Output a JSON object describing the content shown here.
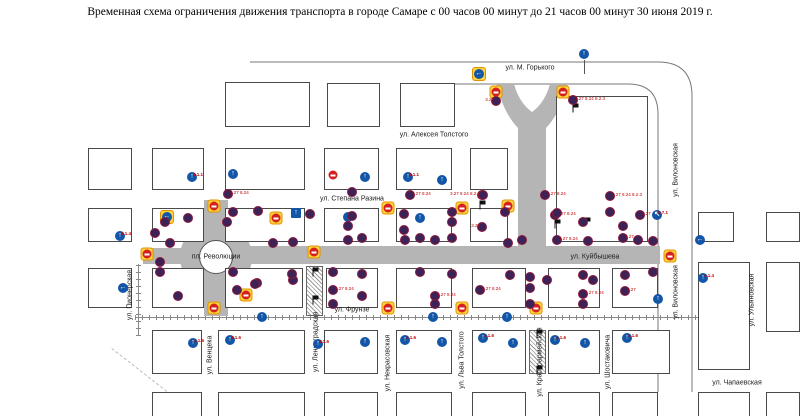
{
  "title": "Временная схема ограничения движения транспорта в городе Самаре  с 00 часов 00 минут  до 21 часов 00 минут 30 июня 2019 г.",
  "map": {
    "colors": {
      "road": "#b5b5b5",
      "no_stop_sign": "#3d2257",
      "no_entry_red": "#d42020",
      "highlight_yellow": "#ffd43a",
      "mandatory_blue": "#1356a8",
      "sign_label_red": "#c00000"
    },
    "square_label": "пл. Революции",
    "blocks": [
      [
        225,
        82,
        85,
        45
      ],
      [
        327,
        83,
        53,
        44
      ],
      [
        400,
        83,
        55,
        44
      ],
      [
        556,
        96,
        92,
        146
      ],
      [
        88,
        148,
        44,
        42
      ],
      [
        152,
        148,
        52,
        42
      ],
      [
        225,
        148,
        80,
        42
      ],
      [
        324,
        148,
        55,
        42
      ],
      [
        396,
        148,
        56,
        42
      ],
      [
        470,
        148,
        38,
        42
      ],
      [
        88,
        208,
        44,
        34
      ],
      [
        152,
        208,
        52,
        34
      ],
      [
        225,
        208,
        80,
        34
      ],
      [
        324,
        208,
        55,
        34
      ],
      [
        396,
        208,
        56,
        34
      ],
      [
        470,
        208,
        38,
        34
      ],
      [
        698,
        212,
        36,
        30
      ],
      [
        766,
        212,
        34,
        30
      ],
      [
        88,
        268,
        44,
        40
      ],
      [
        152,
        268,
        52,
        40
      ],
      [
        225,
        268,
        78,
        40
      ],
      [
        326,
        268,
        52,
        40
      ],
      [
        396,
        268,
        56,
        40
      ],
      [
        472,
        268,
        54,
        40
      ],
      [
        548,
        268,
        52,
        40
      ],
      [
        612,
        268,
        46,
        40
      ],
      [
        698,
        262,
        52,
        108
      ],
      [
        766,
        262,
        34,
        70
      ],
      [
        152,
        330,
        50,
        44
      ],
      [
        218,
        330,
        87,
        44
      ],
      [
        324,
        330,
        54,
        44
      ],
      [
        396,
        330,
        56,
        44
      ],
      [
        472,
        330,
        54,
        44
      ],
      [
        548,
        330,
        52,
        44
      ],
      [
        612,
        330,
        58,
        44
      ],
      [
        152,
        392,
        50,
        26
      ],
      [
        218,
        392,
        87,
        26
      ],
      [
        324,
        392,
        54,
        26
      ],
      [
        396,
        392,
        56,
        26
      ],
      [
        472,
        392,
        54,
        26
      ],
      [
        548,
        392,
        52,
        26
      ],
      [
        612,
        392,
        46,
        26
      ],
      [
        698,
        392,
        52,
        26
      ],
      [
        766,
        392,
        34,
        26
      ]
    ],
    "roads": [
      [
        250,
        246,
        410,
        18
      ],
      [
        143,
        248,
        40,
        16
      ],
      [
        204,
        200,
        24,
        28
      ],
      [
        204,
        290,
        24,
        26
      ]
    ],
    "hatches": [
      [
        306,
        266,
        17,
        50
      ],
      [
        529,
        330,
        17,
        44
      ]
    ],
    "street_labels_h": [
      {
        "t": "ул. М. Горького",
        "x": 530,
        "y": 68
      },
      {
        "t": "ул. Алексея Толстого",
        "x": 434,
        "y": 135
      },
      {
        "t": "ул. Степана Разина",
        "x": 352,
        "y": 199
      },
      {
        "t": "ул. Куйбышева",
        "x": 595,
        "y": 257
      },
      {
        "t": "ул. Фрунзе",
        "x": 352,
        "y": 310
      },
      {
        "t": "ул. Чапаевская",
        "x": 737,
        "y": 383
      },
      {
        "t": "пл. Революции",
        "x": 216,
        "y": 257
      }
    ],
    "street_labels_v": [
      {
        "t": "ул. Пионерская",
        "x": 130,
        "y": 295
      },
      {
        "t": "ул. Венцека",
        "x": 210,
        "y": 355
      },
      {
        "t": "ул. Ленинградская",
        "x": 316,
        "y": 342
      },
      {
        "t": "ул. Некрасовская",
        "x": 388,
        "y": 363
      },
      {
        "t": "ул. Льва Толстого",
        "x": 462,
        "y": 360
      },
      {
        "t": "ул. Красноармейская",
        "x": 540,
        "y": 362
      },
      {
        "t": "ул. Шостаковича",
        "x": 608,
        "y": 362
      },
      {
        "t": "ул. Вилоновская",
        "x": 676,
        "y": 170
      },
      {
        "t": "ул. Вилоновская",
        "x": 676,
        "y": 292
      },
      {
        "t": "ул. Ульяновская",
        "x": 752,
        "y": 300
      }
    ],
    "signs": [
      {
        "t": "ne",
        "x": 496,
        "y": 92
      },
      {
        "t": "ne",
        "x": 563,
        "y": 92
      },
      {
        "t": "ne",
        "x": 214,
        "y": 206
      },
      {
        "t": "ne",
        "x": 147,
        "y": 254
      },
      {
        "t": "ne",
        "x": 276,
        "y": 218
      },
      {
        "t": "ne",
        "x": 314,
        "y": 252
      },
      {
        "t": "ne",
        "x": 388,
        "y": 208
      },
      {
        "t": "ne",
        "x": 462,
        "y": 208
      },
      {
        "t": "ne",
        "x": 508,
        "y": 206
      },
      {
        "t": "ne",
        "x": 214,
        "y": 308
      },
      {
        "t": "ne",
        "x": 388,
        "y": 308
      },
      {
        "t": "ne",
        "x": 462,
        "y": 308
      },
      {
        "t": "ne",
        "x": 536,
        "y": 308
      },
      {
        "t": "ne",
        "x": 670,
        "y": 256
      },
      {
        "t": "ne",
        "x": 246,
        "y": 295
      },
      {
        "t": "nes",
        "x": 333,
        "y": 175
      },
      {
        "t": "by",
        "x": 479,
        "y": 74,
        "g": "←"
      },
      {
        "t": "by",
        "x": 167,
        "y": 217,
        "g": "←"
      },
      {
        "t": "ow",
        "x": 296,
        "y": 213,
        "g": "↑"
      },
      {
        "t": "pole",
        "x": 584,
        "y": 60,
        "h": 14
      },
      {
        "t": "bc",
        "x": 584,
        "y": 54,
        "g": "↑"
      },
      {
        "t": "bc",
        "x": 120,
        "y": 236,
        "g": "↑",
        "l": "4.1.4"
      },
      {
        "t": "bc",
        "x": 123,
        "y": 288,
        "g": "←"
      },
      {
        "t": "bc",
        "x": 192,
        "y": 177,
        "g": "↑",
        "l": "4.1.1"
      },
      {
        "t": "bc",
        "x": 233,
        "y": 174,
        "g": "↑"
      },
      {
        "t": "bc",
        "x": 365,
        "y": 177,
        "g": "↑"
      },
      {
        "t": "bc",
        "x": 408,
        "y": 177,
        "g": "↑",
        "l": "4.1.1"
      },
      {
        "t": "bc",
        "x": 442,
        "y": 180,
        "g": "↑"
      },
      {
        "t": "bc",
        "x": 348,
        "y": 217,
        "g": "↑"
      },
      {
        "t": "bc",
        "x": 420,
        "y": 218,
        "g": "↑"
      },
      {
        "t": "bc",
        "x": 657,
        "y": 215,
        "g": "↖",
        "l": "5.7.1"
      },
      {
        "t": "bc",
        "x": 700,
        "y": 240,
        "g": "←"
      },
      {
        "t": "bc",
        "x": 703,
        "y": 278,
        "g": "↑",
        "l": "4.1.4"
      },
      {
        "t": "bc",
        "x": 658,
        "y": 299,
        "g": "↑"
      },
      {
        "t": "bc",
        "x": 262,
        "y": 317,
        "g": "↑"
      },
      {
        "t": "bc",
        "x": 433,
        "y": 317,
        "g": "↑"
      },
      {
        "t": "bc",
        "x": 507,
        "y": 317,
        "g": "↑"
      },
      {
        "t": "bc",
        "x": 193,
        "y": 343,
        "g": "↑",
        "l": "4.1.6"
      },
      {
        "t": "bc",
        "x": 230,
        "y": 340,
        "g": "↑",
        "l": "4.1.6"
      },
      {
        "t": "bc",
        "x": 318,
        "y": 344,
        "g": "↑",
        "l": "4.1.6"
      },
      {
        "t": "bc",
        "x": 365,
        "y": 342,
        "g": "↑"
      },
      {
        "t": "bc",
        "x": 405,
        "y": 340,
        "g": "↑",
        "l": "4.1.6"
      },
      {
        "t": "bc",
        "x": 442,
        "y": 342,
        "g": "↑"
      },
      {
        "t": "bc",
        "x": 483,
        "y": 338,
        "g": "↑",
        "l": "4.1.6"
      },
      {
        "t": "bc",
        "x": 513,
        "y": 343,
        "g": "↑"
      },
      {
        "t": "bc",
        "x": 555,
        "y": 340,
        "g": "↑",
        "l": "4.1.6"
      },
      {
        "t": "bc",
        "x": 585,
        "y": 343,
        "g": "↑"
      },
      {
        "t": "bc",
        "x": 627,
        "y": 338,
        "g": "↑",
        "l": "4.1.6"
      },
      {
        "t": "fl",
        "x": 573,
        "y": 108
      },
      {
        "t": "fl",
        "x": 480,
        "y": 205
      },
      {
        "t": "fl",
        "x": 555,
        "y": 224
      },
      {
        "t": "fl",
        "x": 585,
        "y": 222
      },
      {
        "t": "fl",
        "x": 313,
        "y": 272
      },
      {
        "t": "fl",
        "x": 313,
        "y": 300
      },
      {
        "t": "fl",
        "x": 537,
        "y": 334
      },
      {
        "t": "fl",
        "x": 537,
        "y": 370
      },
      {
        "t": "ns",
        "x": 496,
        "y": 101,
        "l": "3.27",
        "lp": "lft"
      },
      {
        "t": "ns",
        "x": 573,
        "y": 100,
        "l": "3.27 8.24 8.2.3"
      },
      {
        "t": "ns",
        "x": 482,
        "y": 195,
        "l": "3.27 8.24 8.2.3",
        "lp": "lft"
      },
      {
        "t": "ns",
        "x": 482,
        "y": 227,
        "l": "3.27",
        "lp": "lft"
      },
      {
        "t": "ns",
        "x": 555,
        "y": 215,
        "l": "3.27 8.24"
      },
      {
        "t": "ns",
        "x": 410,
        "y": 195,
        "l": "3.27 8.24"
      },
      {
        "t": "ns",
        "x": 483,
        "y": 195
      },
      {
        "t": "ns",
        "x": 545,
        "y": 195,
        "l": "3.27 8.24"
      },
      {
        "t": "ns",
        "x": 610,
        "y": 196,
        "l": "3.27 8.24 8.2.3"
      },
      {
        "t": "ns",
        "x": 352,
        "y": 192
      },
      {
        "t": "ns",
        "x": 258,
        "y": 211
      },
      {
        "t": "ns",
        "x": 310,
        "y": 214
      },
      {
        "t": "ns",
        "x": 352,
        "y": 216
      },
      {
        "t": "ns",
        "x": 404,
        "y": 214
      },
      {
        "t": "ns",
        "x": 452,
        "y": 212
      },
      {
        "t": "ns",
        "x": 505,
        "y": 212
      },
      {
        "t": "ns",
        "x": 557,
        "y": 213
      },
      {
        "t": "ns",
        "x": 610,
        "y": 212
      },
      {
        "t": "ns",
        "x": 640,
        "y": 215,
        "l": "3.27"
      },
      {
        "t": "ns",
        "x": 165,
        "y": 222
      },
      {
        "t": "ns",
        "x": 227,
        "y": 222
      },
      {
        "t": "ns",
        "x": 348,
        "y": 226
      },
      {
        "t": "ns",
        "x": 404,
        "y": 230
      },
      {
        "t": "ns",
        "x": 452,
        "y": 222
      },
      {
        "t": "ns",
        "x": 583,
        "y": 222
      },
      {
        "t": "ns",
        "x": 623,
        "y": 226
      },
      {
        "t": "ns",
        "x": 188,
        "y": 218
      },
      {
        "t": "ns",
        "x": 233,
        "y": 212
      },
      {
        "t": "ns",
        "x": 155,
        "y": 233
      },
      {
        "t": "ns",
        "x": 170,
        "y": 243
      },
      {
        "t": "ns",
        "x": 160,
        "y": 262
      },
      {
        "t": "ns",
        "x": 237,
        "y": 290
      },
      {
        "t": "ns",
        "x": 257,
        "y": 283
      },
      {
        "t": "ns",
        "x": 273,
        "y": 243
      },
      {
        "t": "ns",
        "x": 293,
        "y": 242
      },
      {
        "t": "ns",
        "x": 293,
        "y": 280
      },
      {
        "t": "ns",
        "x": 228,
        "y": 194,
        "l": "3.27 8.24"
      },
      {
        "t": "ns",
        "x": 348,
        "y": 240
      },
      {
        "t": "ns",
        "x": 362,
        "y": 238
      },
      {
        "t": "ns",
        "x": 405,
        "y": 240
      },
      {
        "t": "ns",
        "x": 420,
        "y": 238
      },
      {
        "t": "ns",
        "x": 435,
        "y": 240
      },
      {
        "t": "ns",
        "x": 452,
        "y": 238
      },
      {
        "t": "ns",
        "x": 508,
        "y": 243
      },
      {
        "t": "ns",
        "x": 522,
        "y": 240
      },
      {
        "t": "ns",
        "x": 557,
        "y": 240,
        "l": "3.27 8.24"
      },
      {
        "t": "ns",
        "x": 588,
        "y": 241
      },
      {
        "t": "ns",
        "x": 623,
        "y": 238,
        "l": "3.27"
      },
      {
        "t": "ns",
        "x": 638,
        "y": 240
      },
      {
        "t": "ns",
        "x": 653,
        "y": 241
      },
      {
        "t": "ns",
        "x": 160,
        "y": 272
      },
      {
        "t": "ns",
        "x": 233,
        "y": 272
      },
      {
        "t": "ns",
        "x": 292,
        "y": 274
      },
      {
        "t": "ns",
        "x": 333,
        "y": 272
      },
      {
        "t": "ns",
        "x": 362,
        "y": 274
      },
      {
        "t": "ns",
        "x": 420,
        "y": 272
      },
      {
        "t": "ns",
        "x": 452,
        "y": 274
      },
      {
        "t": "ns",
        "x": 510,
        "y": 275
      },
      {
        "t": "ns",
        "x": 530,
        "y": 277
      },
      {
        "t": "ns",
        "x": 547,
        "y": 280
      },
      {
        "t": "ns",
        "x": 583,
        "y": 275
      },
      {
        "t": "ns",
        "x": 593,
        "y": 280
      },
      {
        "t": "ns",
        "x": 625,
        "y": 275
      },
      {
        "t": "ns",
        "x": 653,
        "y": 272
      },
      {
        "t": "ns",
        "x": 178,
        "y": 296
      },
      {
        "t": "ns",
        "x": 255,
        "y": 284
      },
      {
        "t": "ns",
        "x": 333,
        "y": 290,
        "l": "3.27 8.24"
      },
      {
        "t": "ns",
        "x": 362,
        "y": 296
      },
      {
        "t": "ns",
        "x": 435,
        "y": 296,
        "l": "3.27 8.24"
      },
      {
        "t": "ns",
        "x": 480,
        "y": 290,
        "l": "3.27 8.24"
      },
      {
        "t": "ns",
        "x": 530,
        "y": 288
      },
      {
        "t": "ns",
        "x": 583,
        "y": 294,
        "l": "3.27 8.24"
      },
      {
        "t": "ns",
        "x": 625,
        "y": 291,
        "l": "3.27"
      },
      {
        "t": "ns",
        "x": 333,
        "y": 304
      },
      {
        "t": "ns",
        "x": 435,
        "y": 304
      },
      {
        "t": "ns",
        "x": 530,
        "y": 304
      },
      {
        "t": "ns",
        "x": 583,
        "y": 304
      }
    ]
  }
}
